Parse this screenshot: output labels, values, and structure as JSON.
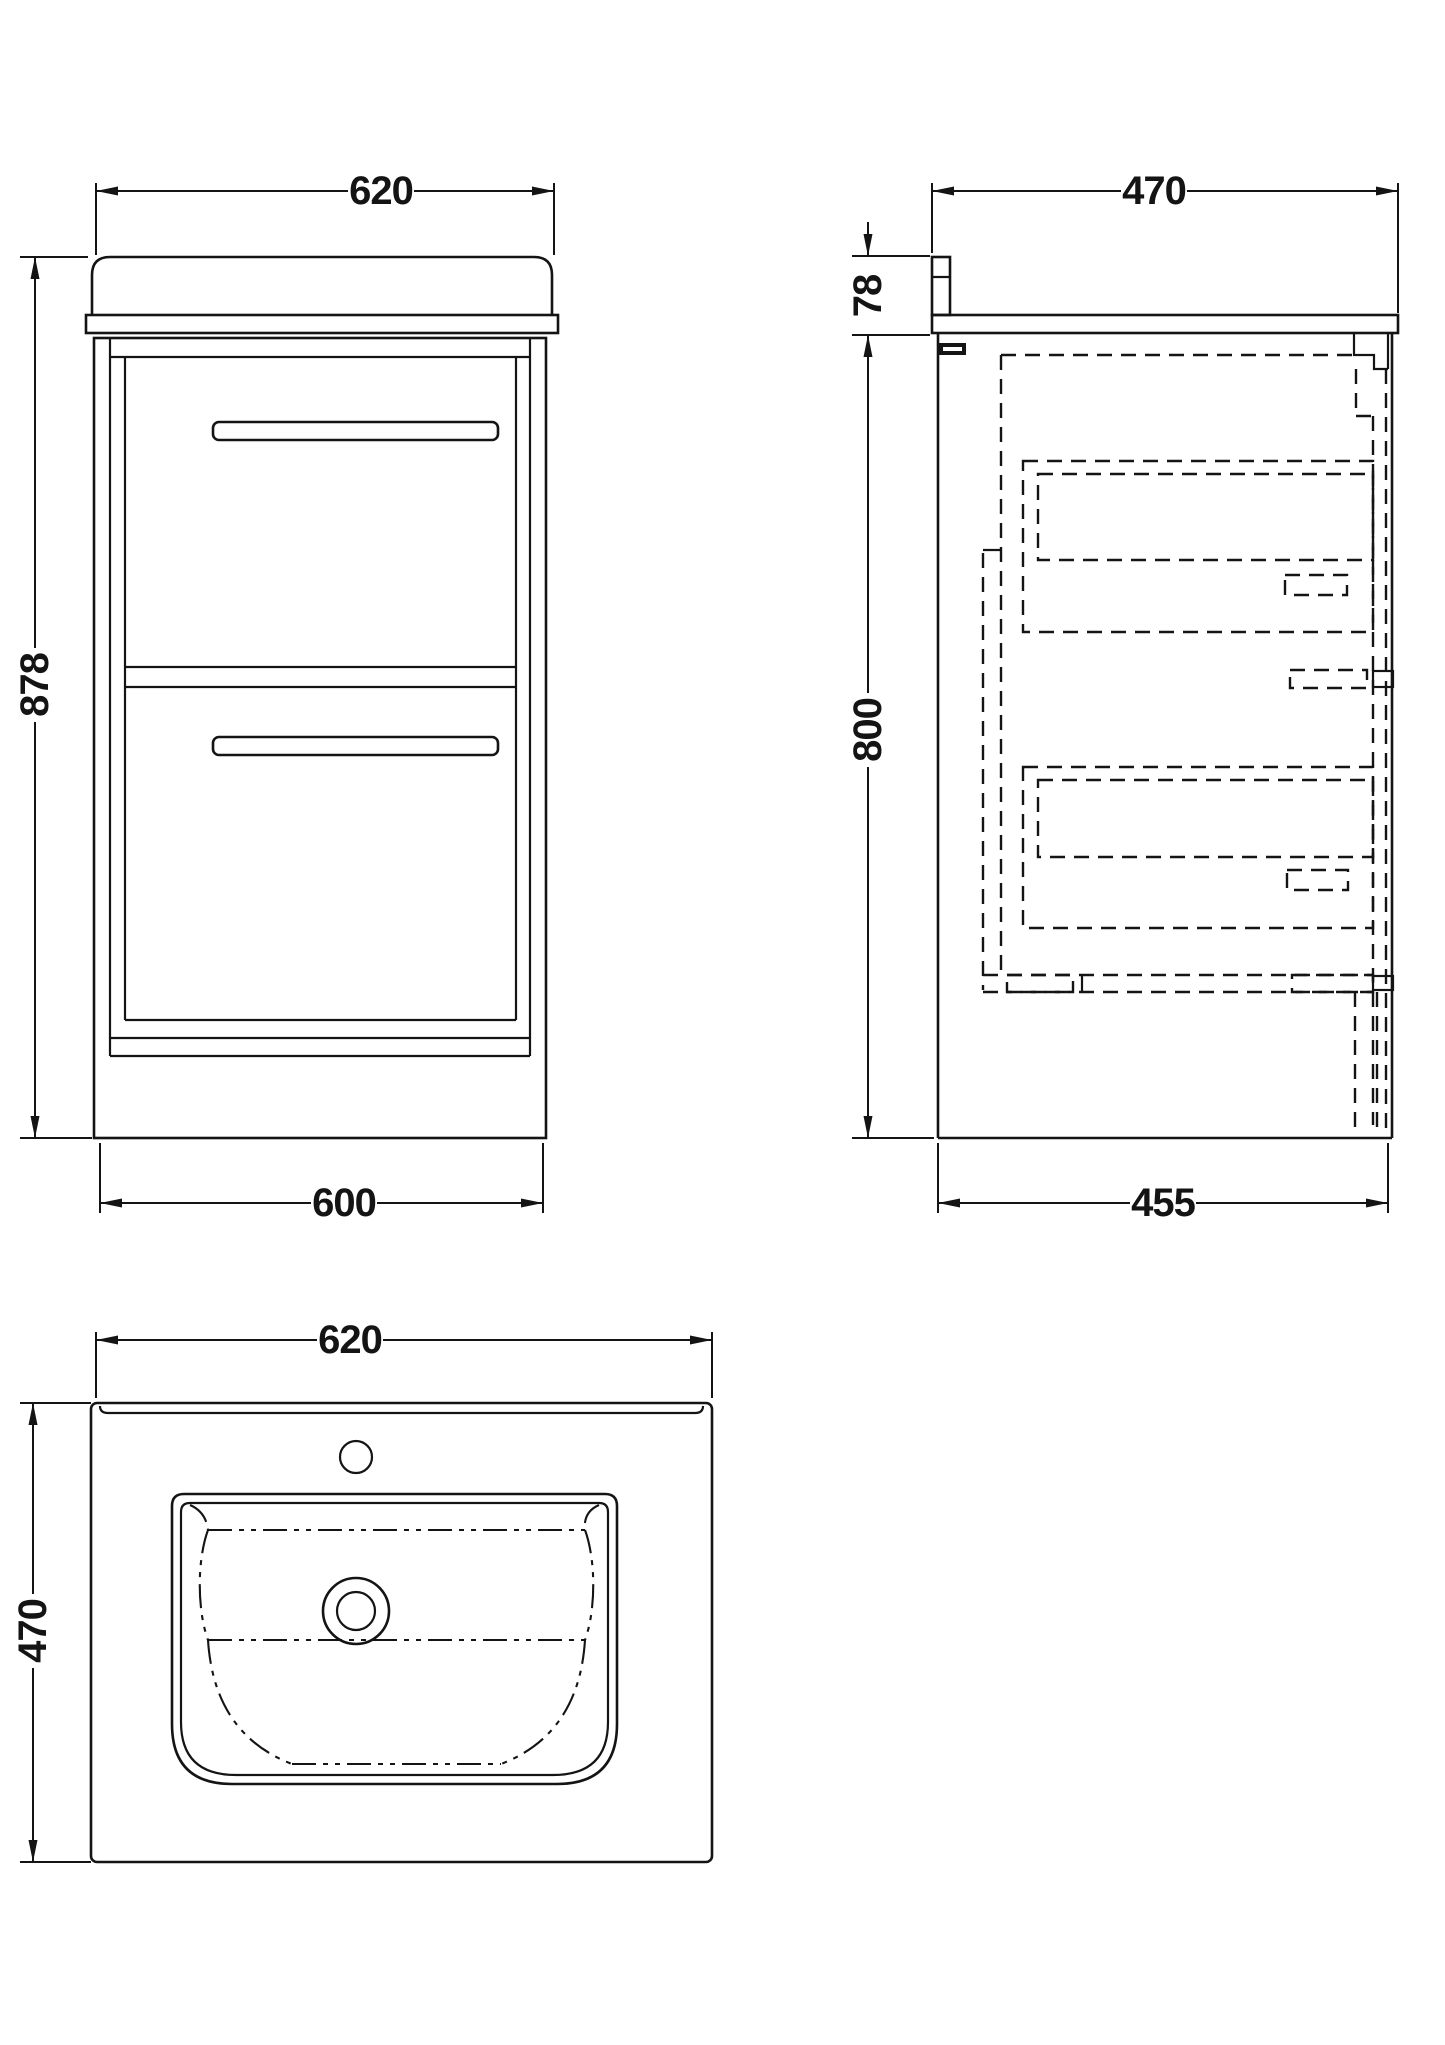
{
  "colors": {
    "line": "#141414",
    "bg": "#ffffff"
  },
  "views": {
    "front": {
      "dim_width_top": "620",
      "dim_height": "878",
      "dim_width_bottom": "600"
    },
    "side": {
      "dim_depth_top": "470",
      "dim_basin_height": "78",
      "dim_cabinet_height": "800",
      "dim_depth_bottom": "455"
    },
    "plan": {
      "dim_width": "620",
      "dim_depth": "470"
    }
  }
}
